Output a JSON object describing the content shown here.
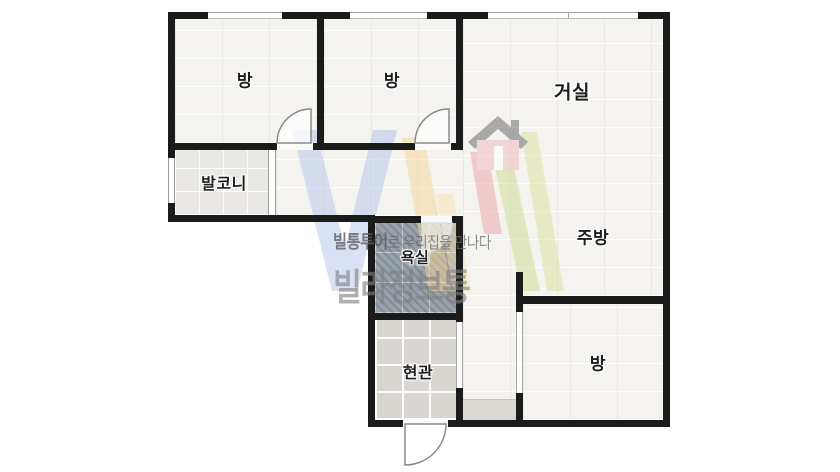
{
  "plan": {
    "type": "apartment-floor-plan",
    "labels": {
      "room_top_left": "방",
      "room_top_mid": "방",
      "living_room": "거실",
      "balcony": "발코니",
      "bathroom": "욕실",
      "kitchen": "주방",
      "entrance": "현관",
      "room_bottom_right": "방"
    },
    "watermark": {
      "tagline_bold": "빌통투어",
      "tagline_rest": "로 우리집을 만나다",
      "brand": "빌라정보통"
    },
    "colors": {
      "wall": "#1b1b1b",
      "room_floor": "#f4f3f0",
      "balcony_tile": "#eae8e4",
      "bathroom_tile": "#98a0a9",
      "entrance_tile": "#d9d6d2",
      "logo_blue": "#b3c3ea",
      "logo_yellow": "#f4d796",
      "logo_red": "#eba3a3",
      "logo_green": "#cddd8e",
      "logo_house_roof": "#5f5f5f",
      "logo_house_body": "#f0b9bd",
      "watermark_text": "#808080"
    }
  }
}
